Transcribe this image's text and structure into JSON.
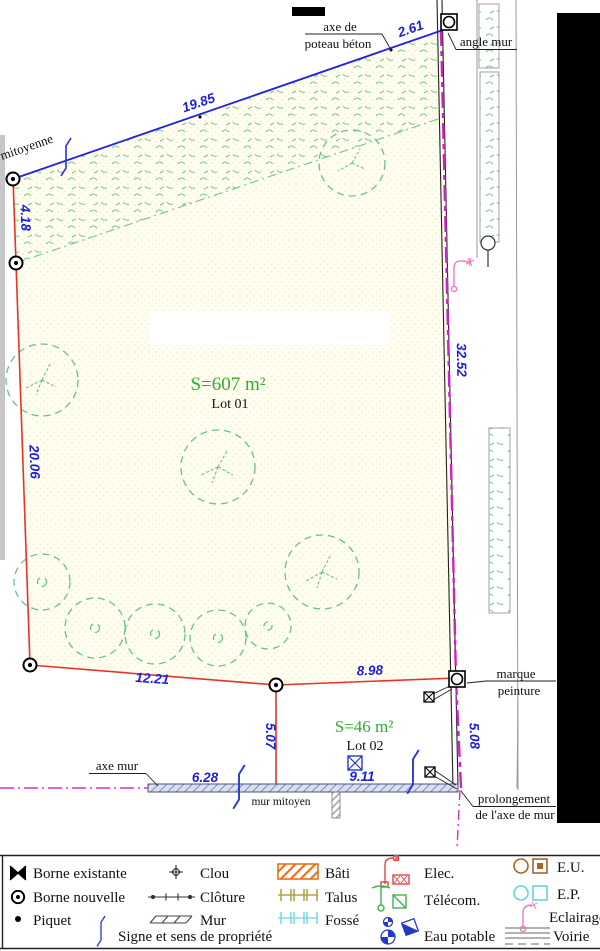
{
  "plan": {
    "lot1": {
      "area": "S=607 m²",
      "name": "Lot 01"
    },
    "lot2": {
      "area": "S=46 m²",
      "name": "Lot 02"
    },
    "dims": {
      "d261": "2.61",
      "d1985": "19.85",
      "d418": "4.18",
      "d2006": "20.06",
      "d3252": "32.52",
      "d1221": "12.21",
      "d898": "8.98",
      "d507": "5.07",
      "d628": "6.28",
      "d911": "9.11",
      "d508": "5.08"
    },
    "labels": {
      "axe_poteau_1": "axe de",
      "axe_poteau_2": "poteau béton",
      "angle_mur": "angle mur",
      "mitoyenne": "mitoyenne",
      "axe_mur": "axe mur",
      "mur_mitoyen": "mur mitoyen",
      "marque_1": "marque",
      "marque_2": "peinture",
      "prolongement_1": "prolongement",
      "prolongement_2": "de l'axe de mur"
    }
  },
  "legend": {
    "borne_existante": "Borne existante",
    "borne_nouvelle": "Borne nouvelle",
    "piquet": "Piquet",
    "signe": "Signe et sens de propriété",
    "clou": "Clou",
    "cloture": "Clôture",
    "mur": "Mur",
    "bati": "Bâti",
    "talus": "Talus",
    "fosse": "Fossé",
    "elec": "Elec.",
    "telecom": "Télécom.",
    "eau_potable": "Eau potable",
    "eu": "E.U.",
    "ep": "E.P.",
    "eclairage": "Eclairage",
    "voirie": "Voirie"
  },
  "colors": {
    "boundary_red": "#e43428",
    "dimension_blue": "#1e1edb",
    "limit_magenta": "#cc22cc",
    "vegetation_green": "#7cc98f",
    "area_green": "#2fae2f",
    "bati_orange": "#e8721c",
    "talus_khaki": "#b5a14e",
    "fosse_cyan": "#7ddde2",
    "elec_red": "#e04545",
    "telecom_green": "#3eb54a",
    "eau_blue": "#2438c8",
    "eu_brown": "#a9632c",
    "ep_cyan": "#66d3dc",
    "eclairage_pink": "#ef79c3"
  }
}
